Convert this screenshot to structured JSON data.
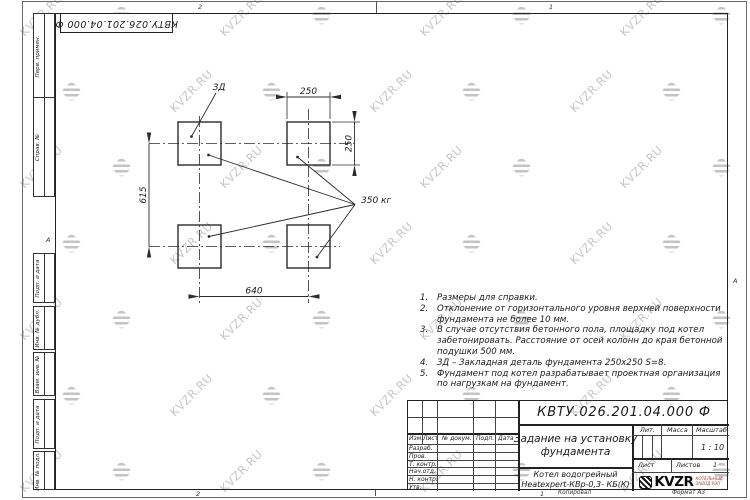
{
  "watermark": {
    "text": "KVZR.RU"
  },
  "sheet": {
    "doc_number_rotated": "КВТУ.026.201.04.000 Ф",
    "zone_top_left": "2",
    "zone_top_right": "1",
    "zone_bottom_left": "2",
    "zone_bottom_right": "1",
    "zone_side_left": "А",
    "zone_side_right": "А",
    "copied_label": "Копировал",
    "format_label": "Формат А3"
  },
  "side_labels": [
    "Перв. примен.",
    "Справ. №",
    "Подп. и дата",
    "Инв. № дубл.",
    "Взам. инв. №",
    "Подп. и дата",
    "Инв. № подл."
  ],
  "drawing": {
    "zd_label": "ЗД",
    "load_label": "350 кг",
    "dim_top": "250",
    "dim_right": "250",
    "dim_left": "615",
    "dim_bottom": "640"
  },
  "notes": {
    "items": [
      {
        "num": "1.",
        "text": "Размеры для справки."
      },
      {
        "num": "2.",
        "text": "Отклонение от горизонтального уровня верхней поверхности фундамента не более 10 мм."
      },
      {
        "num": "3.",
        "text": "В случае отсутствия бетонного пола, площадку под котел забетонировать. Расстояние от осей колонн до края бетонной подушки 500 мм."
      },
      {
        "num": "4.",
        "text": "ЗД – Закладная деталь фундамента 250х250 S=8."
      },
      {
        "num": "5.",
        "text": "Фундамент под котел разрабатывает проектная организация по нагрузкам на фундамент."
      }
    ]
  },
  "title_block": {
    "doc_number": "КВТУ.026.201.04.000 Ф",
    "title_line1": "Задание на установку",
    "title_line2": "фундамента",
    "product_line1": "Котел водогрейный",
    "product_line2": "Heatexpert-КВр-0,3- КБ(К)",
    "header_cols": [
      "Изм.",
      "Лист",
      "№ докум.",
      "Подп.",
      "Дата"
    ],
    "rows": [
      "Разраб.",
      "Пров.",
      "Т. контр.",
      "Нач.отд.",
      "Н. контр.",
      "Утв."
    ],
    "lit_label": "Лит.",
    "mass_label": "Масса",
    "scale_label": "Масштаб",
    "scale_value": "1 : 10",
    "sheet_label": "Лист",
    "sheets_label": "Листов",
    "sheets_value": "1",
    "logo_word": "KVZR",
    "logo_sub1": "КОТЕЛЬНЫЙ",
    "logo_sub2": "ЗАВОД РЭП"
  }
}
